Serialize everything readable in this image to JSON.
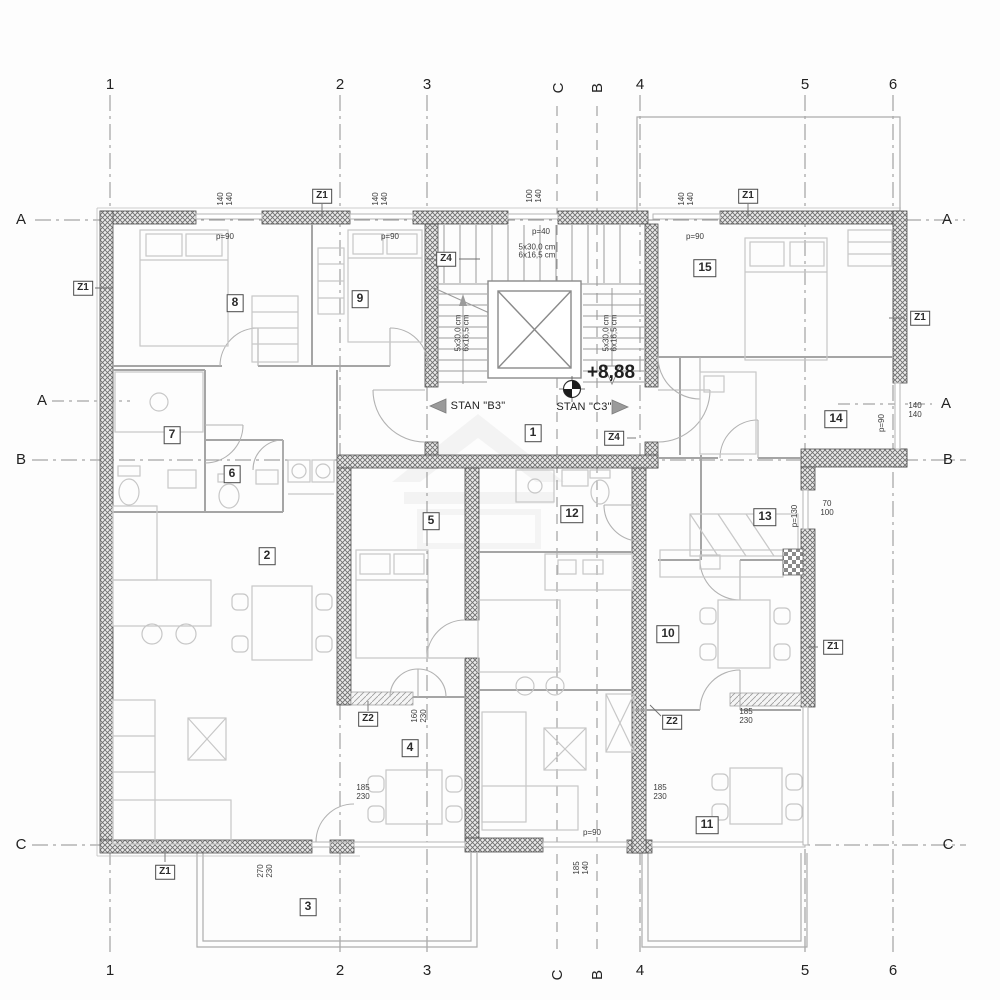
{
  "document": {
    "kind": "architectural floor plan"
  },
  "annotations": {
    "apartment_left": "STAN \"B3\"",
    "apartment_right": "STAN \"C3\"",
    "elevation": "+8,88"
  },
  "labels": {
    "grid": [
      {
        "text": "1",
        "x": 110,
        "y": 85,
        "rot": 0
      },
      {
        "text": "2",
        "x": 340,
        "y": 85,
        "rot": 0
      },
      {
        "text": "3",
        "x": 427,
        "y": 85,
        "rot": 0
      },
      {
        "text": "C",
        "x": 559,
        "y": 88,
        "rot": -90
      },
      {
        "text": "B",
        "x": 598,
        "y": 88,
        "rot": -90
      },
      {
        "text": "4",
        "x": 640,
        "y": 85,
        "rot": 0
      },
      {
        "text": "5",
        "x": 805,
        "y": 85,
        "rot": 0
      },
      {
        "text": "6",
        "x": 893,
        "y": 85,
        "rot": 0
      },
      {
        "text": "1",
        "x": 110,
        "y": 971,
        "rot": 0
      },
      {
        "text": "2",
        "x": 340,
        "y": 971,
        "rot": 0
      },
      {
        "text": "3",
        "x": 427,
        "y": 971,
        "rot": 0
      },
      {
        "text": "C",
        "x": 558,
        "y": 975,
        "rot": -90
      },
      {
        "text": "B",
        "x": 598,
        "y": 975,
        "rot": -90
      },
      {
        "text": "4",
        "x": 640,
        "y": 971,
        "rot": 0
      },
      {
        "text": "5",
        "x": 805,
        "y": 971,
        "rot": 0
      },
      {
        "text": "6",
        "x": 893,
        "y": 971,
        "rot": 0
      },
      {
        "text": "A",
        "x": 21,
        "y": 220,
        "rot": 0
      },
      {
        "text": "A",
        "x": 42,
        "y": 401,
        "rot": 0
      },
      {
        "text": "B",
        "x": 21,
        "y": 460,
        "rot": 0
      },
      {
        "text": "C",
        "x": 21,
        "y": 845,
        "rot": 0
      },
      {
        "text": "A",
        "x": 947,
        "y": 220,
        "rot": 0
      },
      {
        "text": "A",
        "x": 946,
        "y": 404,
        "rot": 0
      },
      {
        "text": "B",
        "x": 948,
        "y": 460,
        "rot": 0
      },
      {
        "text": "C",
        "x": 948,
        "y": 845,
        "rot": 0
      }
    ],
    "rooms": [
      {
        "text": "1",
        "x": 533,
        "y": 433,
        "rot": 0
      },
      {
        "text": "2",
        "x": 267,
        "y": 556,
        "rot": 0
      },
      {
        "text": "3",
        "x": 308,
        "y": 907,
        "rot": 0
      },
      {
        "text": "4",
        "x": 410,
        "y": 748,
        "rot": 0
      },
      {
        "text": "5",
        "x": 431,
        "y": 521,
        "rot": 0
      },
      {
        "text": "6",
        "x": 232,
        "y": 474,
        "rot": 0
      },
      {
        "text": "7",
        "x": 172,
        "y": 435,
        "rot": 0
      },
      {
        "text": "8",
        "x": 235,
        "y": 303,
        "rot": 0
      },
      {
        "text": "9",
        "x": 360,
        "y": 299,
        "rot": 0
      },
      {
        "text": "10",
        "x": 668,
        "y": 634,
        "rot": 0
      },
      {
        "text": "11",
        "x": 707,
        "y": 825,
        "rot": 0
      },
      {
        "text": "12",
        "x": 572,
        "y": 514,
        "rot": 0
      },
      {
        "text": "13",
        "x": 765,
        "y": 517,
        "rot": 0
      },
      {
        "text": "14",
        "x": 836,
        "y": 419,
        "rot": 0
      },
      {
        "text": "15",
        "x": 705,
        "y": 268,
        "rot": 0
      }
    ],
    "zones": [
      {
        "text": "Z1",
        "x": 83,
        "y": 288,
        "rot": 0
      },
      {
        "text": "Z1",
        "x": 322,
        "y": 196,
        "rot": 0
      },
      {
        "text": "Z1",
        "x": 748,
        "y": 196,
        "rot": 0
      },
      {
        "text": "Z1",
        "x": 920,
        "y": 318,
        "rot": 0
      },
      {
        "text": "Z1",
        "x": 833,
        "y": 647,
        "rot": 0
      },
      {
        "text": "Z1",
        "x": 165,
        "y": 872,
        "rot": 0
      },
      {
        "text": "Z2",
        "x": 368,
        "y": 719,
        "rot": 0
      },
      {
        "text": "Z2",
        "x": 672,
        "y": 722,
        "rot": 0
      },
      {
        "text": "Z4",
        "x": 446,
        "y": 259,
        "rot": 0
      },
      {
        "text": "Z4",
        "x": 614,
        "y": 438,
        "rot": 0
      }
    ],
    "dims": [
      {
        "text": "140\n140",
        "x": 225,
        "y": 199,
        "rot": -90
      },
      {
        "text": "140\n140",
        "x": 380,
        "y": 199,
        "rot": -90
      },
      {
        "text": "100\n140",
        "x": 534,
        "y": 196,
        "rot": -90
      },
      {
        "text": "140\n140",
        "x": 686,
        "y": 199,
        "rot": -90
      },
      {
        "text": "140\n140",
        "x": 915,
        "y": 410,
        "rot": 0
      },
      {
        "text": "70\n100",
        "x": 827,
        "y": 508,
        "rot": 0
      },
      {
        "text": "160\n230",
        "x": 419,
        "y": 716,
        "rot": -90
      },
      {
        "text": "185\n230",
        "x": 363,
        "y": 792,
        "rot": 0
      },
      {
        "text": "185\n230",
        "x": 660,
        "y": 792,
        "rot": 0
      },
      {
        "text": "185\n230",
        "x": 746,
        "y": 716,
        "rot": 0
      },
      {
        "text": "270\n230",
        "x": 265,
        "y": 871,
        "rot": -90
      },
      {
        "text": "185\n140",
        "x": 581,
        "y": 868,
        "rot": -90
      }
    ],
    "openings": [
      {
        "text": "p=90",
        "x": 225,
        "y": 237,
        "rot": 0
      },
      {
        "text": "p=90",
        "x": 390,
        "y": 237,
        "rot": 0
      },
      {
        "text": "p=40",
        "x": 541,
        "y": 232,
        "rot": 0
      },
      {
        "text": "p=90",
        "x": 695,
        "y": 237,
        "rot": 0
      },
      {
        "text": "p=90",
        "x": 592,
        "y": 833,
        "rot": 0
      },
      {
        "text": "p=90",
        "x": 882,
        "y": 423,
        "rot": -90
      },
      {
        "text": "p=130",
        "x": 795,
        "y": 516,
        "rot": -90
      }
    ],
    "stairs": [
      {
        "text": "5x30,0 cm\n6x16,5 cm",
        "x": 537,
        "y": 252,
        "rot": 0
      },
      {
        "text": "5x30,0 cm\n6x16,5 cm",
        "x": 463,
        "y": 333,
        "rot": -90
      },
      {
        "text": "5x30,0 cm\n6x16,5 cm",
        "x": 611,
        "y": 333,
        "rot": -90
      }
    ]
  }
}
